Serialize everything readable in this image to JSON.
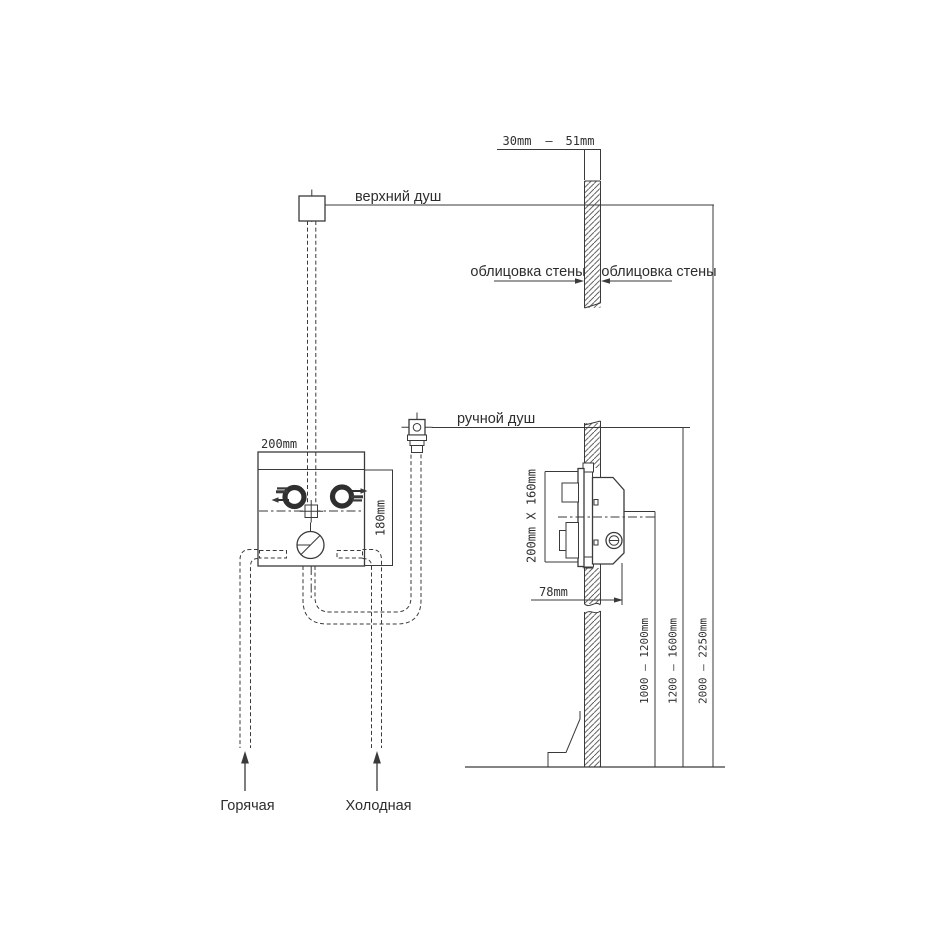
{
  "labels": {
    "overhead_shower": "верхний душ",
    "wall_cladding_left": "облицовка стены",
    "wall_cladding_right": "облицовка стены",
    "hand_shower": "ручной душ",
    "hot_supply": "Горячая",
    "cold_supply": "Холодная"
  },
  "dimensions": {
    "wall_thickness_min": "30mm",
    "wall_thickness_sep": "—",
    "wall_thickness_max": "51mm",
    "valve_box_width": "200mm",
    "valve_box_height": "180mm",
    "rough_in_opening": "200mm X 160mm",
    "box_depth": "78mm",
    "valve_center_height": "1000 — 1200mm",
    "hand_shower_height": "1200 — 1600mm",
    "overhead_shower_height": "2000 — 2250mm"
  },
  "colors": {
    "line": "#3a3a3a",
    "text": "#2d2d2d",
    "background": "#ffffff"
  }
}
